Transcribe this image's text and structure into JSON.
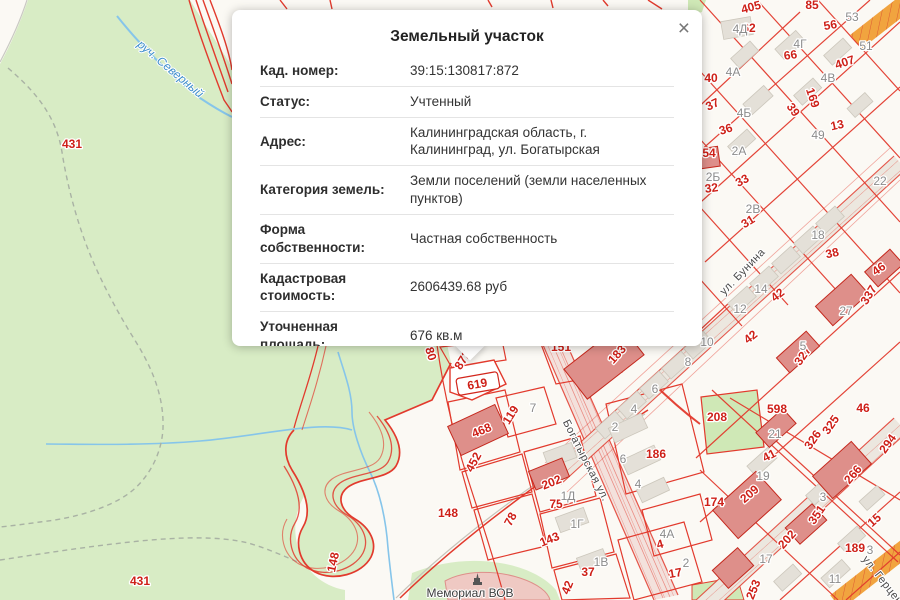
{
  "popup": {
    "title": "Земельный участок",
    "close_glyph": "×",
    "rows": [
      {
        "label": "Кад. номер:",
        "value": "39:15:130817:872"
      },
      {
        "label": "Статус:",
        "value": "Учтенный"
      },
      {
        "label": "Адрес:",
        "value": "Калининградская область, г. Калининград, ул. Богатырская"
      },
      {
        "label": "Категория земель:",
        "value": "Земли поселений (земли населенных пунктов)"
      },
      {
        "label": "Форма собственности:",
        "value": "Частная собственность"
      },
      {
        "label": "Кадастровая стоимость:",
        "value": "2606439.68 руб"
      },
      {
        "label": "Уточненная площадь:",
        "value": "676 кв.м"
      },
      {
        "label": "Разрешенное",
        "value": "для индивидуального жилищного"
      }
    ]
  },
  "map": {
    "colors": {
      "parcel_line": "#e23a2d",
      "green_area": "#d8ecc5",
      "red_label": "#ce2018",
      "gray_label": "#8c8c8c",
      "water": "#86c5ea",
      "water_label": "#3f8ecb",
      "building": "#e4e0d8",
      "red_building": "#de8f8a",
      "orange_road": "#f1a43f"
    },
    "labels": [
      {
        "t": "431",
        "x": 72,
        "y": 148,
        "r": 0,
        "c": "red"
      },
      {
        "t": "431",
        "x": 140,
        "y": 585,
        "r": 0,
        "c": "red"
      },
      {
        "t": "руч. Северный",
        "x": 168,
        "y": 72,
        "r": 40,
        "c": "blue"
      },
      {
        "t": "405",
        "x": 752,
        "y": 11,
        "r": -15,
        "c": "red"
      },
      {
        "t": "85",
        "x": 812,
        "y": 9,
        "r": 0,
        "c": "red"
      },
      {
        "t": "62",
        "x": 749,
        "y": 32,
        "r": 0,
        "c": "red"
      },
      {
        "t": "56",
        "x": 831,
        "y": 29,
        "r": -10,
        "c": "red"
      },
      {
        "t": "66",
        "x": 791,
        "y": 59,
        "r": -8,
        "c": "red"
      },
      {
        "t": "407",
        "x": 846,
        "y": 66,
        "r": -18,
        "c": "red"
      },
      {
        "t": "40",
        "x": 711,
        "y": 82,
        "r": 0,
        "c": "red"
      },
      {
        "t": "37",
        "x": 714,
        "y": 108,
        "r": -25,
        "c": "red"
      },
      {
        "t": "39",
        "x": 790,
        "y": 112,
        "r": 55,
        "c": "red"
      },
      {
        "t": "169",
        "x": 809,
        "y": 99,
        "r": 72,
        "c": "red"
      },
      {
        "t": "36",
        "x": 727,
        "y": 133,
        "r": -18,
        "c": "red"
      },
      {
        "t": "13",
        "x": 838,
        "y": 129,
        "r": -12,
        "c": "red"
      },
      {
        "t": "54",
        "x": 709,
        "y": 157,
        "r": 0,
        "c": "red"
      },
      {
        "t": "33",
        "x": 744,
        "y": 184,
        "r": -28,
        "c": "red"
      },
      {
        "t": "32",
        "x": 712,
        "y": 192,
        "r": -8,
        "c": "red"
      },
      {
        "t": "31",
        "x": 750,
        "y": 225,
        "r": -32,
        "c": "red"
      },
      {
        "t": "38",
        "x": 833,
        "y": 257,
        "r": -12,
        "c": "red"
      },
      {
        "t": "42",
        "x": 780,
        "y": 298,
        "r": -38,
        "c": "red"
      },
      {
        "t": "42",
        "x": 753,
        "y": 340,
        "r": -38,
        "c": "red"
      },
      {
        "t": "46",
        "x": 881,
        "y": 272,
        "r": -35,
        "c": "red"
      },
      {
        "t": "337",
        "x": 872,
        "y": 297,
        "r": -58,
        "c": "red"
      },
      {
        "t": "327",
        "x": 806,
        "y": 358,
        "r": -55,
        "c": "red"
      },
      {
        "t": "46",
        "x": 863,
        "y": 412,
        "r": 0,
        "c": "red"
      },
      {
        "t": "598",
        "x": 777,
        "y": 413,
        "r": 0,
        "c": "red"
      },
      {
        "t": "208",
        "x": 717,
        "y": 421,
        "r": 0,
        "c": "red"
      },
      {
        "t": "326",
        "x": 816,
        "y": 442,
        "r": -55,
        "c": "red"
      },
      {
        "t": "325",
        "x": 834,
        "y": 427,
        "r": -55,
        "c": "red"
      },
      {
        "t": "294",
        "x": 891,
        "y": 446,
        "r": -55,
        "c": "red"
      },
      {
        "t": "41",
        "x": 771,
        "y": 459,
        "r": -28,
        "c": "red"
      },
      {
        "t": "209",
        "x": 752,
        "y": 497,
        "r": -40,
        "c": "red"
      },
      {
        "t": "174",
        "x": 714,
        "y": 506,
        "r": 0,
        "c": "red"
      },
      {
        "t": "266",
        "x": 856,
        "y": 477,
        "r": -50,
        "c": "red"
      },
      {
        "t": "351",
        "x": 820,
        "y": 517,
        "r": -55,
        "c": "red"
      },
      {
        "t": "202",
        "x": 790,
        "y": 542,
        "r": -48,
        "c": "red"
      },
      {
        "t": "15",
        "x": 877,
        "y": 523,
        "r": -42,
        "c": "red"
      },
      {
        "t": "189",
        "x": 855,
        "y": 552,
        "r": 0,
        "c": "red"
      },
      {
        "t": "253",
        "x": 757,
        "y": 591,
        "r": -68,
        "c": "red"
      },
      {
        "t": "151",
        "x": 561,
        "y": 351,
        "r": 0,
        "c": "red"
      },
      {
        "t": "183",
        "x": 620,
        "y": 357,
        "r": -48,
        "c": "red"
      },
      {
        "t": "872",
        "x": 466,
        "y": 362,
        "r": -58,
        "c": "red"
      },
      {
        "t": "619",
        "x": 478,
        "y": 388,
        "r": -10,
        "c": "red"
      },
      {
        "t": "80",
        "x": 427,
        "y": 355,
        "r": 72,
        "c": "red"
      },
      {
        "t": "119",
        "x": 514,
        "y": 417,
        "r": -58,
        "c": "red"
      },
      {
        "t": "468",
        "x": 483,
        "y": 434,
        "r": -22,
        "c": "red"
      },
      {
        "t": "452",
        "x": 477,
        "y": 464,
        "r": -62,
        "c": "red"
      },
      {
        "t": "148",
        "x": 448,
        "y": 517,
        "r": 0,
        "c": "red"
      },
      {
        "t": "148",
        "x": 337,
        "y": 563,
        "r": -78,
        "c": "red"
      },
      {
        "t": "202",
        "x": 553,
        "y": 486,
        "r": -22,
        "c": "red"
      },
      {
        "t": "75",
        "x": 556,
        "y": 508,
        "r": 0,
        "c": "red"
      },
      {
        "t": "78",
        "x": 514,
        "y": 521,
        "r": -62,
        "c": "red"
      },
      {
        "t": "143",
        "x": 551,
        "y": 543,
        "r": -22,
        "c": "red"
      },
      {
        "t": "186",
        "x": 656,
        "y": 458,
        "r": 0,
        "c": "red"
      },
      {
        "t": "37",
        "x": 588,
        "y": 576,
        "r": 0,
        "c": "red"
      },
      {
        "t": "42",
        "x": 571,
        "y": 589,
        "r": -68,
        "c": "red"
      },
      {
        "t": "4",
        "x": 661,
        "y": 548,
        "r": -15,
        "c": "red"
      },
      {
        "t": "17",
        "x": 676,
        "y": 577,
        "r": -10,
        "c": "red"
      },
      {
        "t": "4Д",
        "x": 740,
        "y": 33,
        "r": 0,
        "c": "gray"
      },
      {
        "t": "53",
        "x": 852,
        "y": 21,
        "r": 0,
        "c": "gray"
      },
      {
        "t": "4Г",
        "x": 800,
        "y": 48,
        "r": 0,
        "c": "gray"
      },
      {
        "t": "51",
        "x": 866,
        "y": 50,
        "r": 0,
        "c": "gray"
      },
      {
        "t": "4А",
        "x": 733,
        "y": 76,
        "r": 0,
        "c": "gray"
      },
      {
        "t": "4В",
        "x": 828,
        "y": 82,
        "r": 0,
        "c": "gray"
      },
      {
        "t": "4Б",
        "x": 744,
        "y": 117,
        "r": 0,
        "c": "gray"
      },
      {
        "t": "49",
        "x": 818,
        "y": 139,
        "r": 0,
        "c": "gray"
      },
      {
        "t": "2А",
        "x": 739,
        "y": 155,
        "r": 0,
        "c": "gray"
      },
      {
        "t": "2Б",
        "x": 713,
        "y": 181,
        "r": 0,
        "c": "gray"
      },
      {
        "t": "2В",
        "x": 753,
        "y": 213,
        "r": 0,
        "c": "gray"
      },
      {
        "t": "22",
        "x": 880,
        "y": 185,
        "r": 0,
        "c": "gray"
      },
      {
        "t": "18",
        "x": 818,
        "y": 239,
        "r": 0,
        "c": "gray"
      },
      {
        "t": "14",
        "x": 761,
        "y": 293,
        "r": 0,
        "c": "gray"
      },
      {
        "t": "12",
        "x": 740,
        "y": 313,
        "r": 0,
        "c": "gray"
      },
      {
        "t": "27",
        "x": 846,
        "y": 315,
        "r": 0,
        "c": "gray"
      },
      {
        "t": "5",
        "x": 803,
        "y": 350,
        "r": 0,
        "c": "gray"
      },
      {
        "t": "10",
        "x": 707,
        "y": 346,
        "r": 0,
        "c": "gray"
      },
      {
        "t": "8",
        "x": 688,
        "y": 366,
        "r": 0,
        "c": "gray"
      },
      {
        "t": "6",
        "x": 655,
        "y": 393,
        "r": 0,
        "c": "gray"
      },
      {
        "t": "4",
        "x": 634,
        "y": 413,
        "r": 0,
        "c": "gray"
      },
      {
        "t": "2",
        "x": 615,
        "y": 431,
        "r": 0,
        "c": "gray"
      },
      {
        "t": "6",
        "x": 623,
        "y": 463,
        "r": 0,
        "c": "gray"
      },
      {
        "t": "4",
        "x": 638,
        "y": 488,
        "r": 0,
        "c": "gray"
      },
      {
        "t": "21",
        "x": 775,
        "y": 438,
        "r": 0,
        "c": "gray"
      },
      {
        "t": "19",
        "x": 763,
        "y": 480,
        "r": 0,
        "c": "gray"
      },
      {
        "t": "3",
        "x": 823,
        "y": 501,
        "r": 0,
        "c": "gray"
      },
      {
        "t": "3",
        "x": 870,
        "y": 554,
        "r": 0,
        "c": "gray"
      },
      {
        "t": "17",
        "x": 766,
        "y": 563,
        "r": 0,
        "c": "gray"
      },
      {
        "t": "11",
        "x": 835,
        "y": 583,
        "r": 0,
        "c": "gray"
      },
      {
        "t": "1Д",
        "x": 568,
        "y": 500,
        "r": 0,
        "c": "gray"
      },
      {
        "t": "1Г",
        "x": 577,
        "y": 528,
        "r": 0,
        "c": "gray"
      },
      {
        "t": "1В",
        "x": 601,
        "y": 566,
        "r": 0,
        "c": "gray"
      },
      {
        "t": "4А",
        "x": 667,
        "y": 538,
        "r": 0,
        "c": "gray"
      },
      {
        "t": "2",
        "x": 686,
        "y": 567,
        "r": 0,
        "c": "gray"
      },
      {
        "t": "7",
        "x": 533,
        "y": 412,
        "r": 0,
        "c": "gray"
      },
      {
        "t": "Богатырская ул.",
        "x": 583,
        "y": 462,
        "r": 63,
        "c": "street"
      },
      {
        "t": "ул. Бунина",
        "x": 745,
        "y": 274,
        "r": -46,
        "c": "street"
      },
      {
        "t": "ул. Герцена",
        "x": 882,
        "y": 585,
        "r": 52,
        "c": "street"
      },
      {
        "t": "Мемориал ВОВ",
        "x": 470,
        "y": 597,
        "r": 0,
        "c": "dark"
      }
    ]
  }
}
